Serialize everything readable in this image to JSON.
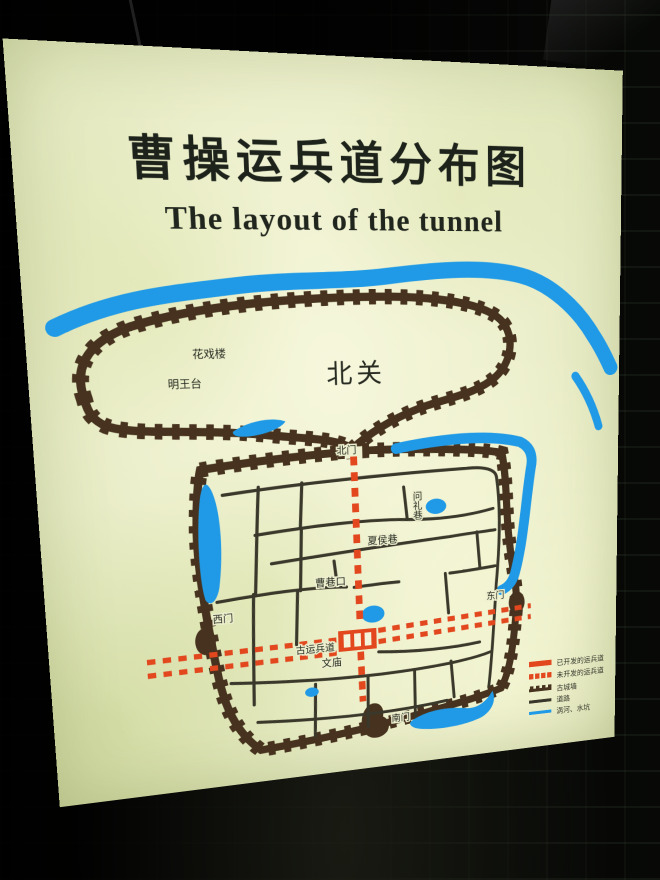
{
  "sign": {
    "title_cn": "曹操运兵道分布图",
    "title_en": "The layout of the tunnel"
  },
  "map": {
    "district_label": "北关",
    "landmarks": {
      "hua_xi_lou": "花戏楼",
      "ming_wang_tai": "明王台",
      "gu_yun_bing_dao": "古运兵道",
      "wen_miao": "文庙"
    },
    "gates": {
      "north": "北门",
      "west": "西门",
      "east": "东门",
      "south": "南门"
    },
    "streets": {
      "wen_li_xiang": "问礼巷",
      "xia_hou_xiang": "夏侯巷",
      "cao_xiang_kou": "曹巷口"
    },
    "legend": {
      "items": [
        {
          "key": "developed-tunnel",
          "label": "已开发的运兵道"
        },
        {
          "key": "undeveloped-tunnel",
          "label": "未开发的运兵道"
        },
        {
          "key": "ancient-city-wall",
          "label": "古城墙"
        },
        {
          "key": "road",
          "label": "道路"
        },
        {
          "key": "river-and-ponds",
          "label": "涡河、水坑"
        }
      ]
    },
    "colors": {
      "tunnel_red": "#e2471e",
      "water_blue": "#209ae6",
      "wall_brown": "#46321e",
      "road_dark": "#3a382b",
      "sign_background": "#eef0cf"
    }
  }
}
